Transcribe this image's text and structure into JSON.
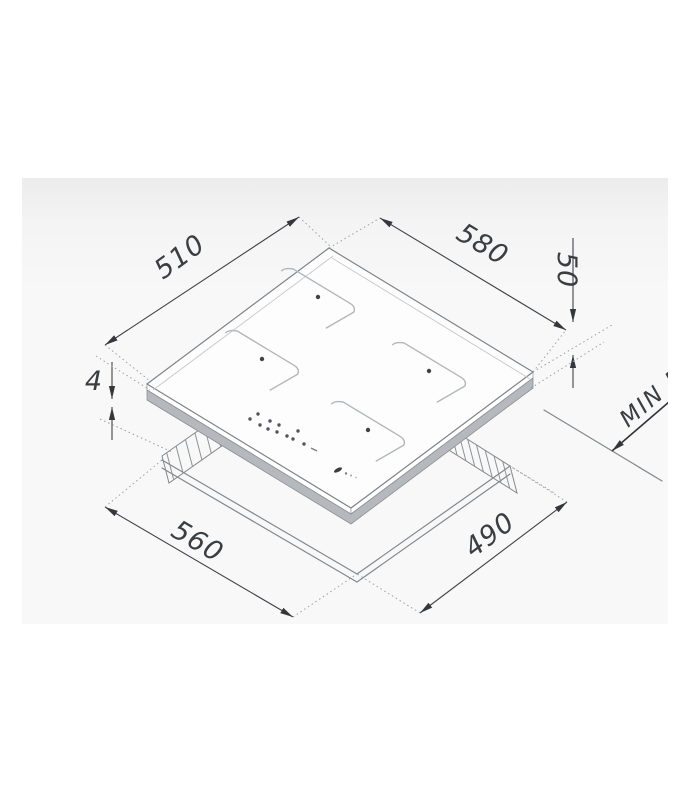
{
  "dims": {
    "top_width": {
      "label": "510"
    },
    "top_depth": {
      "label": "580"
    },
    "height": {
      "label": "50"
    },
    "glass_step": {
      "label": "4"
    },
    "min_clearance": {
      "label": "MIN 5"
    },
    "cutout_width": {
      "label": "560"
    },
    "cutout_depth": {
      "label": "490"
    }
  },
  "colors": {
    "panel_bg": "#f8f8f8",
    "drawing_line": "#83888c",
    "dimension_line": "#3f4347",
    "body_band": "#b5b9bd",
    "glass_fill": "#fdfdfd"
  }
}
